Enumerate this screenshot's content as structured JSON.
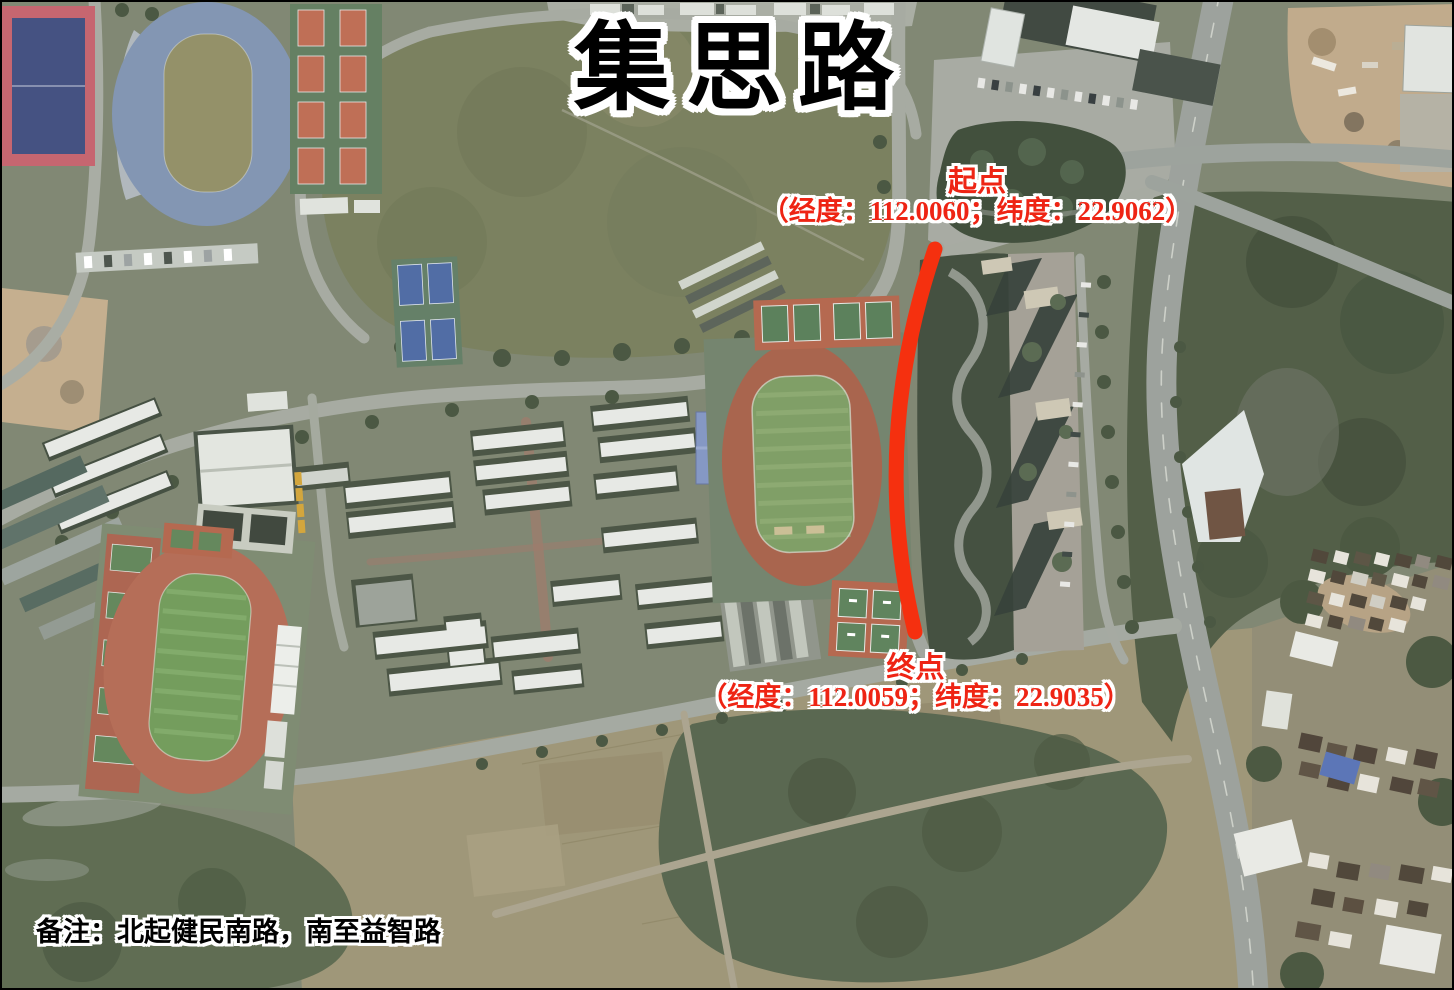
{
  "map": {
    "road_name": "集思路",
    "note": "备注：北起健民南路，南至益智路",
    "start_point": {
      "label": "起点",
      "coordinates": "（经度：112.0060；纬度：22.9062）",
      "longitude": "112.0060",
      "latitude": "22.9062"
    },
    "end_point": {
      "label": "终点",
      "coordinates": "（经度：112.0059；纬度：22.9035）",
      "longitude": "112.0059",
      "latitude": "22.9035"
    },
    "marker": {
      "color": "#f5300f"
    },
    "text_colors": {
      "annotation_red": "#ee2414",
      "title_black": "#000000",
      "outline_white": "#ffffff"
    }
  }
}
